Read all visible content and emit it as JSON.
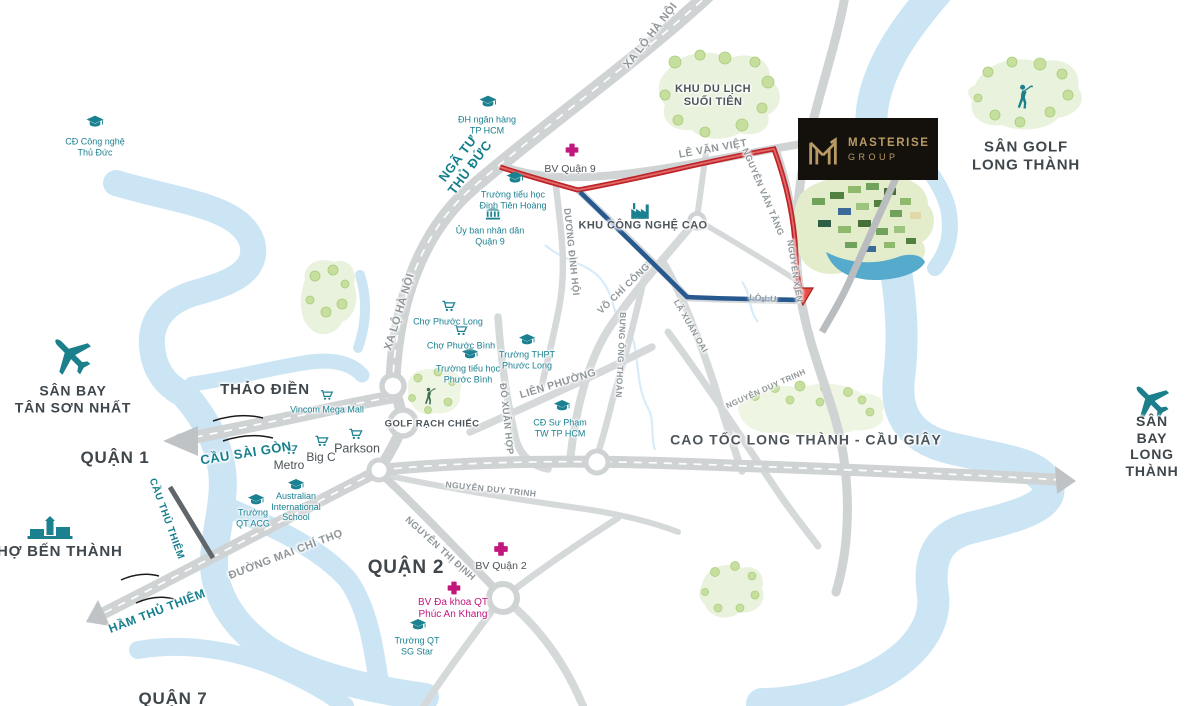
{
  "brand": {
    "name": "MASTERISE",
    "division": "GROUP"
  },
  "districts": [
    {
      "text": "QUẬN 1"
    },
    {
      "text": "QUẬN 2"
    },
    {
      "text": "QUẬN 7"
    },
    {
      "text": "THẢO ĐIỀN"
    },
    {
      "text": "CHỢ BẾN THÀNH"
    }
  ],
  "airports": [
    {
      "text": "SÂN BAY\nTÂN SƠN NHẤT",
      "icon": "airplane"
    },
    {
      "text": "SÂN BAY\nLONG THÀNH",
      "icon": "airplane"
    }
  ],
  "areas": [
    {
      "text": "SÂN GOLF\nLONG THÀNH",
      "icon": "golfer"
    },
    {
      "text": "KHU DU LỊCH\nSUỐI TIÊN"
    },
    {
      "text": "GOLF RẠCH CHIẾC",
      "icon": "golfer"
    },
    {
      "text": "KHU CÔNG NGHỆ CAO",
      "icon": "factory"
    }
  ],
  "roads": [
    {
      "text": "XA LỘ HÀ NỘI"
    },
    {
      "text": "XA LỘ HÀ NỘI"
    },
    {
      "text": "LÊ VĂN VIỆT"
    },
    {
      "text": "NGUYỄN VĂN TĂNG"
    },
    {
      "text": "NGUYỄN XIỂN"
    },
    {
      "text": "DƯƠNG ĐÌNH HỘI"
    },
    {
      "text": "VÕ CHÍ CÔNG"
    },
    {
      "text": "LÃ XUÂN OAI"
    },
    {
      "text": "LÒ LU"
    },
    {
      "text": "BƯNG ÔNG THOÀN"
    },
    {
      "text": "LIÊN PHƯỜNG"
    },
    {
      "text": "ĐỖ XUÂN HỢP"
    },
    {
      "text": "NGUYỄN DUY TRINH"
    },
    {
      "text": "NGUYỄN DUY TRINH"
    },
    {
      "text": "CAO TỐC LONG THÀNH - CẦU GIÂY"
    },
    {
      "text": "ĐƯỜNG MAI CHÍ THỌ"
    },
    {
      "text": "NGUYỄN THỊ ĐỊNH"
    }
  ],
  "landmarks": [
    {
      "text": "NGÃ TƯ\nTHỦ ĐỨC"
    },
    {
      "text": "CẦU SÀI GÒN"
    },
    {
      "text": "CẦU THỦ THIÊM"
    },
    {
      "text": "HẦM THỦ THIÊM"
    }
  ],
  "pois": [
    {
      "text": "CĐ Công nghệ\nThủ Đức",
      "icon": "graduation-cap"
    },
    {
      "text": "ĐH ngân hàng\nTP HCM",
      "icon": "graduation-cap"
    },
    {
      "text": "BV Quận 9",
      "icon": "medical-cross"
    },
    {
      "text": "Trường tiểu học\nĐinh Tiên Hoàng",
      "icon": "graduation-cap"
    },
    {
      "text": "Ủy ban nhân dân\nQuận 9",
      "icon": "government-building"
    },
    {
      "text": "Chợ Phước Long",
      "icon": "shopping-cart"
    },
    {
      "text": "Chợ Phước Bình",
      "icon": "shopping-cart"
    },
    {
      "text": "Trường tiểu học\nPhước Bình",
      "icon": "graduation-cap"
    },
    {
      "text": "Trường THPT\nPhước Long",
      "icon": "graduation-cap"
    },
    {
      "text": "CĐ Sư Phạm\nTW TP HCM",
      "icon": "graduation-cap"
    },
    {
      "text": "Vincom Mega Mall",
      "icon": "shopping-cart"
    },
    {
      "text": "Metro",
      "icon": "shopping-cart"
    },
    {
      "text": "Big C",
      "icon": "shopping-cart"
    },
    {
      "text": "Parkson",
      "icon": "shopping-cart"
    },
    {
      "text": "Trường\nQT ACG",
      "icon": "graduation-cap"
    },
    {
      "text": "Australian\nInternational\nSchool",
      "icon": "graduation-cap"
    },
    {
      "text": "BV Quận 2",
      "icon": "medical-cross"
    },
    {
      "text": "BV Đa khoa QT\nPhúc An Khang",
      "icon": "medical-cross"
    },
    {
      "text": "Trường QT\nSG Star",
      "icon": "graduation-cap"
    }
  ],
  "colors": {
    "teal": "#1b8191",
    "magenta": "#c2187e",
    "route_red": "#bf2429",
    "route_blue": "#27598f",
    "river": "#cbe5f5",
    "green_area": "#e9f2dc",
    "road_gray": "#d0d3d4",
    "brand_gold": "#b99a64",
    "brand_bg": "#14110d"
  }
}
